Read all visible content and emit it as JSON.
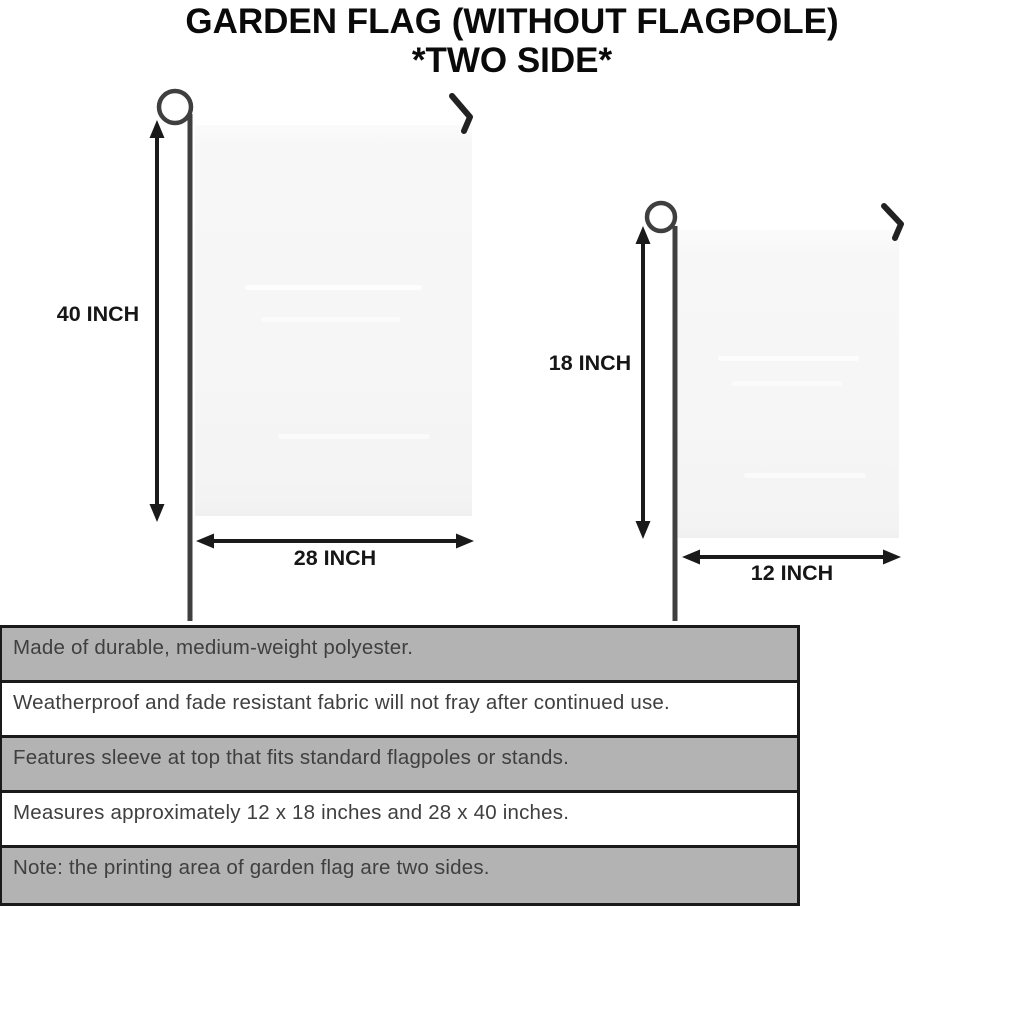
{
  "title": {
    "line1": "GARDEN FLAG (WITHOUT FLAGPOLE)",
    "line2": "*TWO SIDE*"
  },
  "diagram": {
    "large_flag": {
      "height_label": "40 INCH",
      "width_label": "28 INCH"
    },
    "small_flag": {
      "height_label": "18 INCH",
      "width_label": "12 INCH"
    }
  },
  "specs": {
    "rows": [
      {
        "text": "Made of durable, medium-weight polyester."
      },
      {
        "text": "Weatherproof and fade resistant fabric will not fray after continued use."
      },
      {
        "text": "Features sleeve at top that fits standard flagpoles or stands."
      },
      {
        "text": "Measures approximately 12 x 18 inches and 28 x 40 inches."
      },
      {
        "text": "Note: the printing area of garden flag are two sides."
      }
    ]
  },
  "colors": {
    "shaded_row": "#b3b3b3",
    "row_border": "#1a1a1a",
    "flag_fill": "#f6f6f6",
    "pole": "#3f3f3f",
    "arrow": "#1a1a1a",
    "table_text": "#3f3f3f",
    "title_text": "#0a0a0a"
  }
}
